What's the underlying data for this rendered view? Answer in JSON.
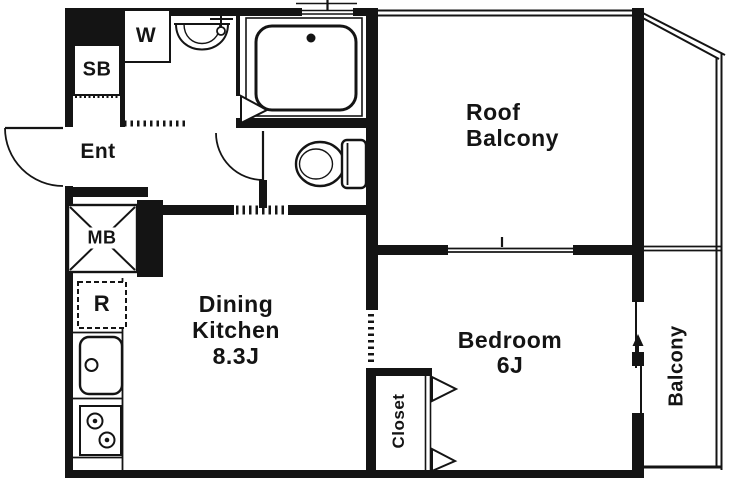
{
  "rooms": {
    "dining_kitchen": {
      "name_line1": "Dining",
      "name_line2": "Kitchen",
      "size": "8.3J"
    },
    "bedroom": {
      "name": "Bedroom",
      "size": "6J"
    },
    "roof_balcony": {
      "name_line1": "Roof",
      "name_line2": "Balcony"
    },
    "balcony": {
      "name": "Balcony"
    },
    "closet": {
      "name": "Closet"
    },
    "entrance": {
      "abbr": "Ent"
    }
  },
  "labels": {
    "shoe_box_abbr": "SB",
    "washing_machine_abbr": "W",
    "meter_box_abbr": "MB",
    "refrigerator_abbr": "R"
  },
  "colors": {
    "ink": "#141414",
    "background": "#ffffff"
  }
}
